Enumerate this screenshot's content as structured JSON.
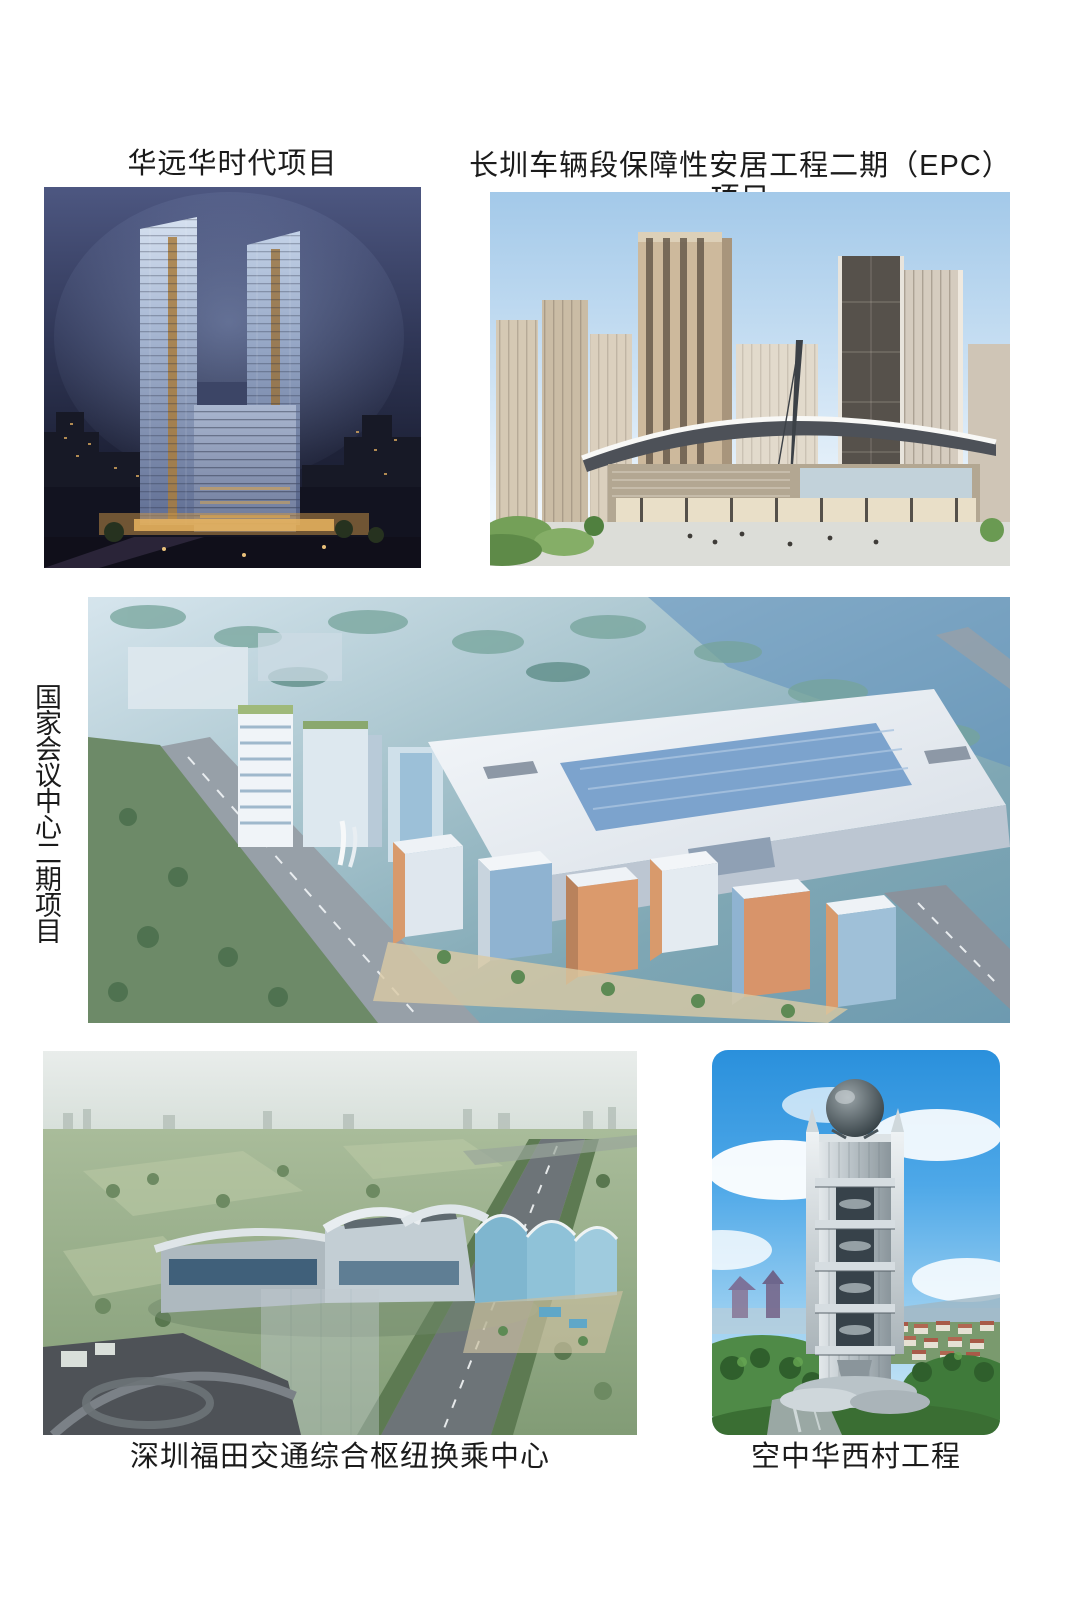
{
  "page": {
    "background": "#ffffff",
    "description": "Portfolio page of five construction project renderings with captions"
  },
  "projects": [
    {
      "id": "huayuan-huashidai",
      "caption": "华远华时代项目",
      "caption_position": "above-image",
      "image_alt": "night-render-twin-glass-towers",
      "dominant_colors": [
        "#2b3152",
        "#9fb0cc",
        "#c28f43"
      ]
    },
    {
      "id": "changzhen-depot-housing",
      "caption": "长圳车辆段保障性安居工程二期（EPC）项目",
      "caption_position": "above-image",
      "image_alt": "day-render-residential-towers-with-curved-canopy",
      "dominant_colors": [
        "#a3c9e9",
        "#cdb99c",
        "#56514b"
      ]
    },
    {
      "id": "national-convention-center-phase2",
      "caption": "国家会议中心二期项目",
      "caption_position": "left-vertical",
      "image_alt": "blue-tinted-aerial-render-convention-center-complex",
      "dominant_colors": [
        "#8fb4c4",
        "#e8edf3",
        "#d89a6c"
      ]
    },
    {
      "id": "shenzhen-futian-hub",
      "caption": "深圳福田交通综合枢纽换乘中心",
      "caption_position": "below-image",
      "image_alt": "hazy-aerial-render-transport-interchange-terminal",
      "dominant_colors": [
        "#a9bc9a",
        "#c3ced4",
        "#4e5257"
      ]
    },
    {
      "id": "sky-huaxi-village",
      "caption": "空中华西村工程",
      "caption_position": "below-image",
      "image_alt": "blue-sky-render-cylindrical-tower-with-sphere-top",
      "dominant_colors": [
        "#2a90dc",
        "#b9c2c7",
        "#4f8a47"
      ]
    }
  ],
  "palette": {
    "caption_text": "#1b1b1b",
    "page_background": "#ffffff"
  }
}
